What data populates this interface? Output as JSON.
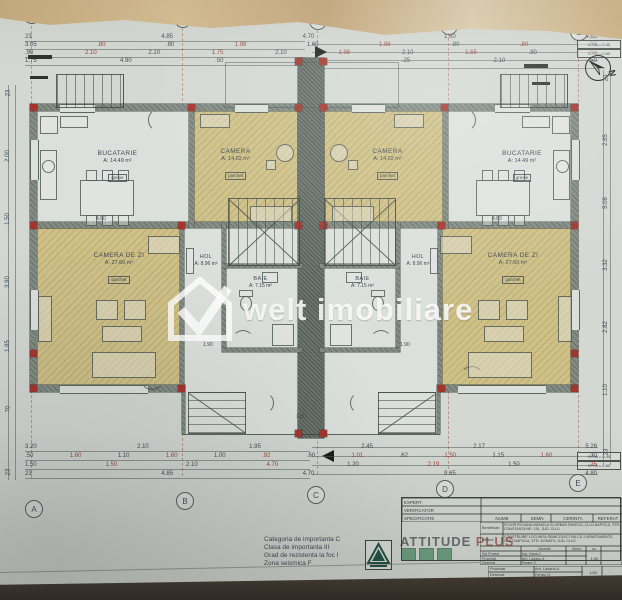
{
  "watermark": {
    "text": "welt imobiliare"
  },
  "north": "N",
  "grid": {
    "letters": [
      "A",
      "B",
      "C",
      "D",
      "E"
    ]
  },
  "elevations": {
    "cta": "C.T.A.=-0.45",
    "cts": "C.T.S.=-0.60"
  },
  "rooms": {
    "bucatarie_left": {
      "name": "BUCATARIE",
      "area": "A: 14.49 m²",
      "finish": "gresie"
    },
    "camera_left": {
      "name": "CAMERA",
      "area": "A: 14.02 m²",
      "finish": "parchet"
    },
    "camera_right": {
      "name": "CAMERA",
      "area": "A: 14.02 m²",
      "finish": "parchet"
    },
    "bucatarie_right": {
      "name": "BUCATARIE",
      "area": "A: 14.49 m²",
      "finish": "gresie"
    },
    "living_left": {
      "name": "CAMERA DE ZI",
      "area": "A: 27.60 m²",
      "finish": "parchet"
    },
    "living_right": {
      "name": "CAMERA DE ZI",
      "area": "A: 27.60 m²",
      "finish": "parchet"
    },
    "hol_left": {
      "name": "HOL",
      "area": "A: 8.96 m²"
    },
    "hol_right": {
      "name": "HOL",
      "area": "A: 8.96 m²"
    },
    "baie_left": {
      "name": "BAIE",
      "area": "A: 7.15 m²"
    },
    "baie_right": {
      "name": "BAIE",
      "area": "A: 7.15 m²"
    }
  },
  "dims": {
    "top1": [
      "23",
      "4.85",
      "4.70",
      "1.60",
      "4.65"
    ],
    "top2": [
      "3.05",
      ".80",
      ".80",
      "1.98",
      "1.60",
      "1.98",
      ".80",
      ".80",
      ".55"
    ],
    "top3": [
      ".90",
      "2.10",
      "2.10",
      "1.75",
      "2.10",
      "1.98",
      "2.10",
      "1.65",
      ".90",
      ".55"
    ],
    "top4": [
      "1.75",
      "4.90",
      ".50",
      "2.10",
      ".25",
      "2.10",
      ".50"
    ],
    "bottom1": [
      "3.20",
      "2.10",
      "1.95",
      "2.45",
      "2.17",
      "5.28"
    ],
    "bottom2": [
      ".50",
      "1.60",
      "1.10",
      "1.60",
      "1.00",
      ".92",
      ".60",
      "1.01",
      ".62",
      "1.50",
      "1.15",
      "1.60",
      ".30"
    ],
    "bottom3": [
      "1.50",
      "1.50",
      "2.10",
      "4.70",
      "1.20",
      "2.19",
      "1.50",
      ".25"
    ],
    "bottom4": [
      "23",
      "4.85",
      "4.70",
      "9.65",
      "4.80"
    ],
    "left": [
      "23",
      "2.00",
      "1.50",
      "3.90",
      "1.85",
      "70",
      "23"
    ],
    "right": [
      "23",
      "2.85",
      "5.08",
      "3.32",
      "2.82",
      "1.10",
      "23"
    ],
    "inner_living_left": "4.60",
    "inner_living_right": "4.60",
    "inner_left": "1.90",
    "inner_right": "1.90",
    "inner_center": "1.80"
  },
  "notes": [
    "Categoria de importanta C",
    "Clasa de importanta III",
    "Grad de rezistenta la foc I",
    "Zona seismica F"
  ],
  "brand": {
    "name": "ATTITUDE",
    "suffix": "PLUS"
  },
  "title_block": {
    "expert": "EXPERT",
    "verificator": "VERIFICATOR",
    "specificatie": "SPECIFICATIE",
    "nume": "NUME",
    "semn": "SEMN",
    "cerinta": "CERINTA",
    "referat": "REFERAT",
    "beneficiar_label": "Beneficiar:",
    "beneficiar": "FICIOR ROXANA-MIHAELA SI URBAN RAVECA, CLUJ-NAPOCA, STR. CONSTANTA NR. 151, JUD. CLUJ",
    "obiect_label": "Obiect:",
    "obiect": "CONSTRUIRE LOCUINTA SEMICOLECTIVA CU 2 APARTAMENTE, CLUJ-NAPOCA, STR. DONATH, JUD. CLUJ",
    "numele": "Numele",
    "semn_col": "Semn.",
    "scara_label": "sc.",
    "scara": "1:50",
    "staff": [
      [
        "Sef Proiect",
        "Ing. Voina C."
      ],
      [
        "Proiectat",
        "Arh. Ladariu A."
      ],
      [
        "Desenat",
        "Feraru O."
      ]
    ],
    "strip": {
      "r1": [
        "Proiectat",
        "Arh. Ladariu A.",
        "1:50"
      ],
      "r2": [
        "Desenat",
        "Feraru O."
      ]
    }
  }
}
